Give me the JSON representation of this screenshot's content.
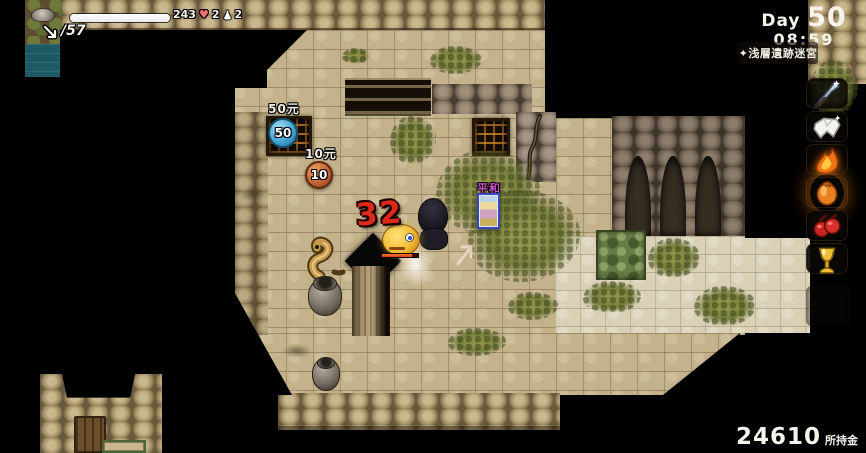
{
  "hud": {
    "hp_value": "243",
    "heart_count": "2",
    "potion_count": "2",
    "ammo_count": "/57",
    "day_prefix": "Day",
    "day_number": "50",
    "time": "08:59",
    "location_label": "✦浅層遺跡迷宮",
    "money_value": "24610",
    "money_suffix": "所持金"
  },
  "world": {
    "damage_number": "32",
    "card_name": "平和",
    "price_tags": [
      {
        "label": "50元",
        "coin": "50"
      },
      {
        "label": "10元",
        "coin": "10"
      }
    ]
  },
  "item_bar": {
    "slots": [
      "sword-icon",
      "white-cloth-icon",
      "flame-icon",
      "lantern-icon",
      "red-gloves-icon",
      "gold-goblet-icon"
    ]
  },
  "colors": {
    "damage_red": "#e02818",
    "coin_blue": "#3f9fd0",
    "coin_copper": "#c06030",
    "card_label_magenta": "#d050d0",
    "floor_tan": "#c3b28a"
  }
}
